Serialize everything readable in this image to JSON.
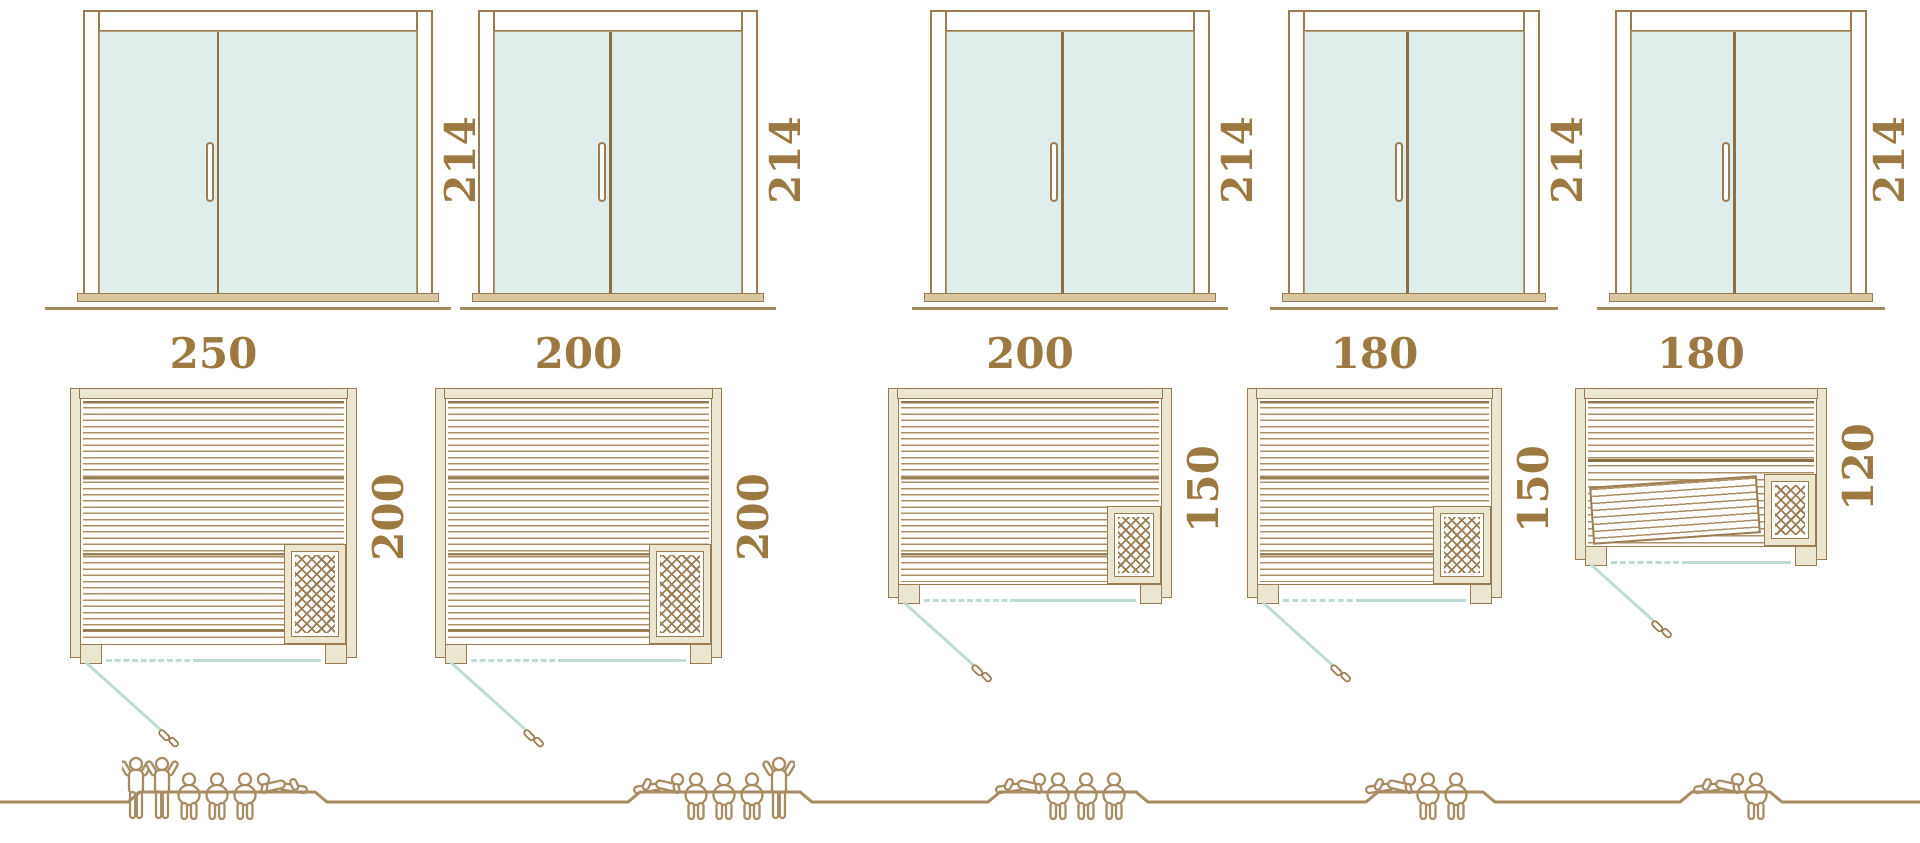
{
  "title": "Sauna size comparison diagram",
  "colors": {
    "outline_brown": "#9b7b51",
    "wall_beige": "#eae6d2",
    "glass_teal": "#dfeeea",
    "door_line_teal": "#bfdbd5",
    "dimension_text": "#9d7942",
    "figure_brown": "#a78c63"
  },
  "units": [
    {
      "name": "sauna-250x200",
      "door_height_cm": "214",
      "width_cm": "250",
      "depth_cm": "200",
      "capacity": {
        "standing": 2,
        "sitting": 3,
        "lying": 1
      },
      "arrangement": [
        "standing",
        "standing",
        "sitting",
        "sitting",
        "sitting",
        "lying-right"
      ]
    },
    {
      "name": "sauna-200x200",
      "door_height_cm": "214",
      "width_cm": "200",
      "depth_cm": "200",
      "capacity": {
        "standing": 1,
        "sitting": 3,
        "lying": 1
      },
      "arrangement": [
        "lying-left",
        "sitting",
        "sitting",
        "sitting",
        "standing"
      ]
    },
    {
      "name": "sauna-200x150",
      "door_height_cm": "214",
      "width_cm": "200",
      "depth_cm": "150",
      "capacity": {
        "standing": 0,
        "sitting": 3,
        "lying": 1
      },
      "arrangement": [
        "lying-left",
        "sitting",
        "sitting",
        "sitting"
      ]
    },
    {
      "name": "sauna-180x150",
      "door_height_cm": "214",
      "width_cm": "180",
      "depth_cm": "150",
      "capacity": {
        "standing": 0,
        "sitting": 2,
        "lying": 1
      },
      "arrangement": [
        "lying-left",
        "sitting",
        "sitting"
      ]
    },
    {
      "name": "sauna-180x120",
      "door_height_cm": "214",
      "width_cm": "180",
      "depth_cm": "120",
      "capacity": {
        "standing": 0,
        "sitting": 1,
        "lying": 1
      },
      "arrangement": [
        "lying-left",
        "sitting"
      ]
    }
  ]
}
